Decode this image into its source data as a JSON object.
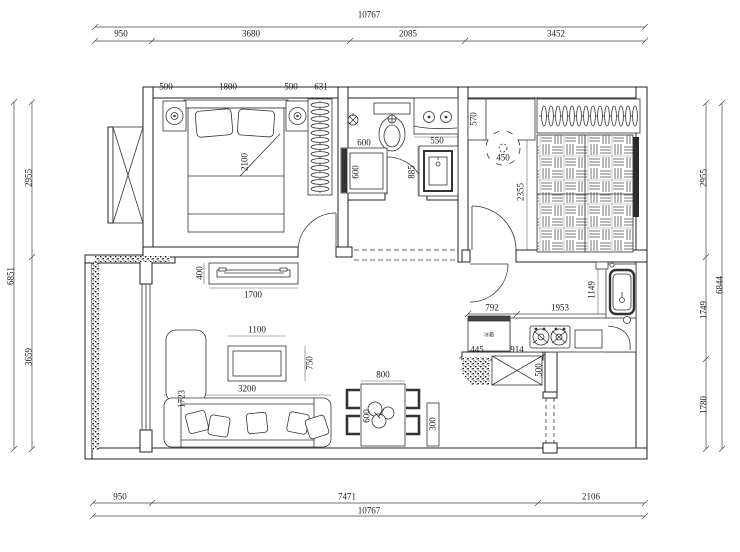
{
  "plan": {
    "dims_top": {
      "total": "10767",
      "s1": "950",
      "s2": "3680",
      "s3": "2085",
      "s4": "3452"
    },
    "dims_bottom": {
      "total": "10767",
      "s1": "950",
      "s2": "7471",
      "s3": "2106"
    },
    "dims_left": {
      "total": "6851",
      "s1": "2955",
      "s2": "3659"
    },
    "dims_right": {
      "total": "6844",
      "s1": "2955",
      "s2": "1749",
      "s3": "1780"
    },
    "master_bedroom": {
      "d500a": "500",
      "d1800": "1800",
      "d500b": "500",
      "d631": "631",
      "bed_length": "2100"
    },
    "bathroom": {
      "washer_width": "600",
      "washer_depth": "600",
      "vanity_width": "550",
      "door_width": "885"
    },
    "second_bedroom": {
      "cabinet_depth": "570",
      "table_dia": "450",
      "room_depth": "2355"
    },
    "kitchen": {
      "d792": "792",
      "d1953": "1953",
      "d1149": "1149",
      "d445": "445",
      "d914": "914",
      "shaft_width": "500",
      "fridge_label": "冰箱"
    },
    "living_room": {
      "tv_depth": "400",
      "tv_width": "1700",
      "table_width": "1100",
      "table_depth": "750",
      "sofa_width": "3200",
      "zone_depth": "1723"
    },
    "dining": {
      "table_width": "800",
      "table_depth": "600",
      "console_depth": "300"
    }
  }
}
